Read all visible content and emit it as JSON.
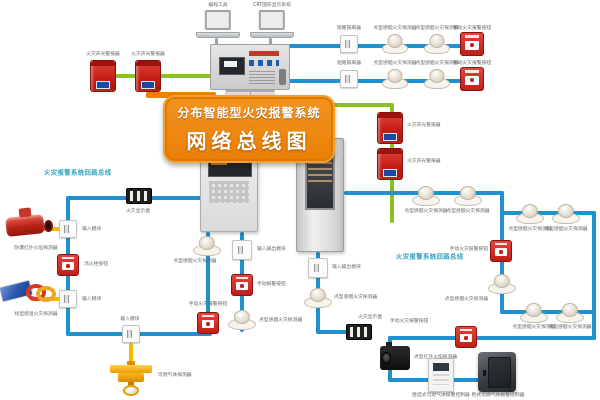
{
  "banner": {
    "line1": "分布智能型火灾报警系统",
    "line2": "网络总线图"
  },
  "loop_labels": {
    "left": "火灾报警系统回路总线",
    "right": "火灾报警系统回路总线"
  },
  "colors": {
    "bus_blue": "#1f91cf",
    "bus_green": "#8bc220",
    "branch_yellow": "#f5b800",
    "banner_orange": "#ee8100",
    "alarm_red": "#c21d15",
    "loop_label": "#2fa0bf"
  },
  "devices": [
    {
      "id": "laptop1",
      "type": "laptop",
      "name": "programming-laptop",
      "label": "编程工具"
    },
    {
      "id": "laptop2",
      "type": "laptop",
      "name": "crt-graphic-display-laptop",
      "label": "CRT图形显示系统"
    },
    {
      "id": "alarm1",
      "type": "alarm-box",
      "name": "sound-light-alarm",
      "label": "火灾声光警报器"
    },
    {
      "id": "alarm2",
      "type": "alarm-box",
      "name": "sound-light-alarm",
      "label": "火灾声光警报器"
    },
    {
      "id": "r1mod",
      "type": "module",
      "name": "short-circuit-isolator",
      "label": "短路隔离器"
    },
    {
      "id": "r1det1",
      "type": "smoke-detector",
      "name": "smoke-detector",
      "label": "点型感烟火灾探测器"
    },
    {
      "id": "r1det2",
      "type": "smoke-detector",
      "name": "smoke-detector",
      "label": "点型感烟火灾探测器"
    },
    {
      "id": "r1cp",
      "type": "call-point",
      "name": "manual-call-point",
      "label": "手动火灾报警按钮"
    },
    {
      "id": "r2mod",
      "type": "module",
      "name": "short-circuit-isolator",
      "label": "短路隔离器"
    },
    {
      "id": "r2det1",
      "type": "smoke-detector",
      "name": "smoke-detector",
      "label": "点型感烟火灾探测器"
    },
    {
      "id": "r2det2",
      "type": "smoke-detector",
      "name": "smoke-detector",
      "label": "点型感烟火灾探测器"
    },
    {
      "id": "r2cp",
      "type": "call-point",
      "name": "manual-call-point",
      "label": "手动火灾报警按钮"
    },
    {
      "id": "alarm3",
      "type": "alarm-box",
      "name": "sound-light-alarm",
      "label": "火灾声光警报器"
    },
    {
      "id": "alarm4",
      "type": "alarm-box",
      "name": "sound-light-alarm",
      "label": "火灾声光警报器"
    },
    {
      "id": "display1",
      "type": "display-panel",
      "name": "fire-display-panel",
      "label": "火灾显示盘"
    },
    {
      "id": "mod1",
      "type": "module",
      "name": "input-module",
      "label": "输入模块"
    },
    {
      "id": "flame",
      "type": "flame-detector",
      "name": "explosion-proof-ir-flame-detector",
      "label": "防爆红外火焰探测器"
    },
    {
      "id": "hydrant",
      "type": "call-point",
      "name": "hydrant-button",
      "label": "消火栓按钮"
    },
    {
      "id": "mod2",
      "type": "module",
      "name": "input-module",
      "label": "输入模块"
    },
    {
      "id": "linear",
      "type": "linear-heat",
      "name": "linear-heat-detector",
      "label": "线型感温火灾探测器"
    },
    {
      "id": "mod3",
      "type": "module",
      "name": "input-module",
      "label": "输入模块"
    },
    {
      "id": "gas",
      "type": "gas-detector",
      "name": "combustible-gas-detector",
      "label": "可燃气体探测器"
    },
    {
      "id": "lcall",
      "type": "call-point",
      "name": "manual-call-point",
      "label": "手动火灾报警按钮"
    },
    {
      "id": "cdetA",
      "type": "smoke-detector",
      "name": "smoke-detector",
      "label": "点型感烟火灾探测器"
    },
    {
      "id": "ioB1",
      "type": "module",
      "name": "io-module",
      "label": "输入输出模块"
    },
    {
      "id": "cpB",
      "type": "call-point",
      "name": "manual-call-point",
      "label": "手动报警按钮"
    },
    {
      "id": "cdetB",
      "type": "smoke-detector",
      "name": "smoke-detector",
      "label": "点型感烟火灾探测器"
    },
    {
      "id": "ioC",
      "type": "module",
      "name": "io-module",
      "label": "输入输出模块"
    },
    {
      "id": "cdetC",
      "type": "smoke-detector",
      "name": "smoke-detector",
      "label": "点型感烟火灾探测器"
    },
    {
      "id": "display2",
      "type": "display-panel",
      "name": "fire-display-panel",
      "label": "火灾显示盘"
    },
    {
      "id": "rdet1",
      "type": "smoke-detector",
      "name": "smoke-detector",
      "label": "点型感烟火灾探测器"
    },
    {
      "id": "rdet2",
      "type": "smoke-detector",
      "name": "smoke-detector",
      "label": "点型感烟火灾探测器"
    },
    {
      "id": "rdet3",
      "type": "smoke-detector",
      "name": "smoke-detector",
      "label": "点型感烟火灾探测器"
    },
    {
      "id": "rdet4",
      "type": "smoke-detector",
      "name": "smoke-detector",
      "label": "点型感烟火灾探测器"
    },
    {
      "id": "rdet5",
      "type": "smoke-detector",
      "name": "smoke-detector",
      "label": "点型感烟火灾探测器"
    },
    {
      "id": "rdet6",
      "type": "smoke-detector",
      "name": "smoke-detector",
      "label": "点型感烟火灾探测器"
    },
    {
      "id": "rcp1",
      "type": "call-point",
      "name": "manual-call-point",
      "label": "手动火灾报警按钮"
    },
    {
      "id": "rdetM",
      "type": "smoke-detector",
      "name": "smoke-detector",
      "label": "点型感烟火灾探测器"
    },
    {
      "id": "rcp2",
      "type": "call-point",
      "name": "manual-call-point",
      "label": "手动火灾报警按钮"
    },
    {
      "id": "blackdev",
      "type": "black-cam",
      "name": "ir-flame-detector",
      "label": "点型红外火焰探测器"
    },
    {
      "id": "wctrl",
      "type": "white-controller",
      "name": "wall-gas-alarm-controller",
      "label": "壁挂式可燃气体报警控制器"
    },
    {
      "id": "safe",
      "type": "safe-box",
      "name": "cabinet-gas-alarm-controller",
      "label": "柜式可燃气体报警控制器"
    }
  ],
  "equipment": {
    "console_name": "graphic-control-console",
    "wall_panel_name": "wall-mounted-fire-alarm-control-panel",
    "cabinet_name": "cabinet-fire-alarm-controller"
  }
}
